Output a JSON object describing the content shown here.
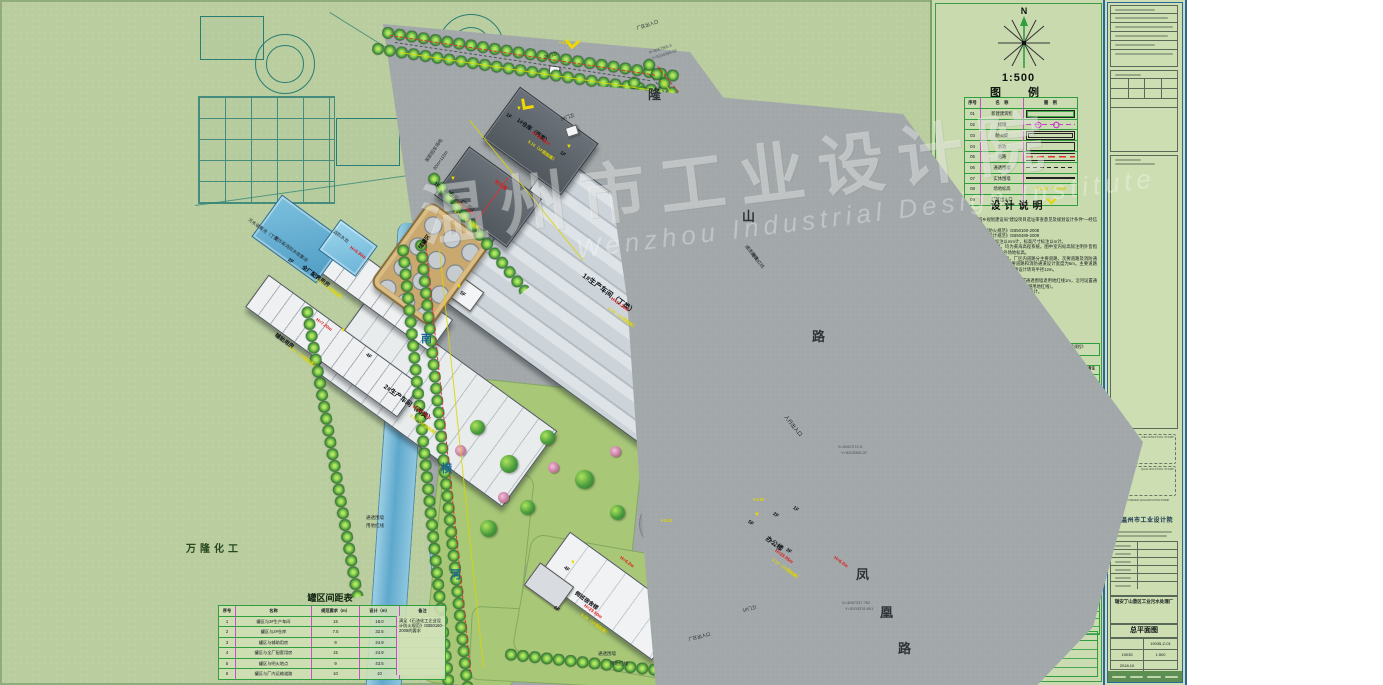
{
  "colors": {
    "sheet": "#b9cd9e",
    "road_gray": "#a2a7a9",
    "lawn": "#a8c878",
    "water": "#6fb4d6",
    "red_line": "#e03030",
    "dim_yellow": "#ded600",
    "table_magenta": "#c84fc8",
    "table_green": "#2f9e3f",
    "pad_tan": "#c9a96f",
    "logo_blue": "#1565c0"
  },
  "watermark": {
    "cn": "温州市工业设计院",
    "en": "Wenzhou Industrial Design Institute"
  },
  "plan": {
    "spacing_table": {
      "title": "罐区间距表",
      "headers": [
        "序号",
        "名称",
        "规范要求（m）",
        "设计（m）",
        "备注"
      ],
      "rows": [
        {
          "no": "1",
          "name": "罐区与2#生产车间",
          "req": "15",
          "des": "18.0"
        },
        {
          "no": "2",
          "name": "罐区与2#仓库",
          "req": "7.5",
          "des": "32.5"
        },
        {
          "no": "3",
          "name": "罐区与辅助用房",
          "req": "9",
          "des": "24.9"
        },
        {
          "no": "4",
          "name": "罐区与全厂配套用房",
          "req": "15",
          "des": "24.9"
        },
        {
          "no": "5",
          "name": "罐区与明火地点",
          "req": "9",
          "des": "43.5"
        },
        {
          "no": "6",
          "name": "罐区与厂内运输道路",
          "req": "10",
          "des": "10"
        }
      ],
      "note": "满足《石油化工企业设计防火规范》GB50160-2008的要求"
    },
    "labels": [
      {
        "t": "瑞安丁山垦区工业污水处理厂",
        "x": 213,
        "y": 62,
        "c": "site",
        "s": 13
      },
      {
        "t": "万隆化工",
        "x": 186,
        "y": 540,
        "c": "site2",
        "s": 10
      },
      {
        "t": "南",
        "x": 421,
        "y": 330,
        "c": "riv"
      },
      {
        "t": "横",
        "x": 441,
        "y": 460,
        "c": "riv"
      },
      {
        "t": "河",
        "x": 450,
        "y": 566,
        "c": "riv"
      },
      {
        "t": "隆",
        "x": 648,
        "y": 84,
        "c": "road"
      },
      {
        "t": "山",
        "x": 742,
        "y": 206,
        "c": "road"
      },
      {
        "t": "路",
        "x": 812,
        "y": 326,
        "c": "road"
      },
      {
        "t": "凤",
        "x": 856,
        "y": 564,
        "c": "road"
      },
      {
        "t": "凰",
        "x": 880,
        "y": 602,
        "c": "road"
      },
      {
        "t": "路",
        "x": 898,
        "y": 638,
        "c": "road"
      },
      {
        "t": "厂区出入口",
        "x": 636,
        "y": 26,
        "r": -18,
        "c": "sm"
      },
      {
        "t": "X=3067560.3",
        "x": 648,
        "y": 50,
        "r": -18,
        "c": "coord"
      },
      {
        "t": "Y=5200399.62",
        "x": 651,
        "y": 56,
        "r": -18,
        "c": "coord"
      },
      {
        "t": "2#门卫",
        "x": 543,
        "y": 55,
        "r": -18,
        "c": "sm"
      },
      {
        "t": "3#门卫",
        "x": 560,
        "y": 117,
        "r": -18,
        "c": "sm"
      },
      {
        "t": "装卸回车场地",
        "x": 424,
        "y": 160,
        "r": -55,
        "c": "sm"
      },
      {
        "t": "30m×110m",
        "x": 432,
        "y": 168,
        "r": -55,
        "c": "sm"
      },
      {
        "t": "人行出入口",
        "x": 788,
        "y": 414,
        "r": 51,
        "c": "s m"
      },
      {
        "t": "厂区出入口",
        "x": 688,
        "y": 637,
        "r": -14,
        "c": "sm"
      },
      {
        "t": "1#门卫",
        "x": 742,
        "y": 608,
        "r": -14,
        "c": "sm"
      },
      {
        "t": "X=3067274.5",
        "x": 838,
        "y": 444,
        "c": "coord"
      },
      {
        "t": "Y=5203356.37",
        "x": 841,
        "y": 450,
        "c": "coord"
      },
      {
        "t": "X=3067237.762",
        "x": 842,
        "y": 600,
        "c": "coord"
      },
      {
        "t": "Y=5203376.691",
        "x": 845,
        "y": 606,
        "c": "coord"
      },
      {
        "t": "通透围墙",
        "x": 748,
        "y": 244,
        "r": 51,
        "c": "sm"
      },
      {
        "t": "用地红线",
        "x": 754,
        "y": 252,
        "r": 51,
        "c": "sm"
      },
      {
        "t": "通透围墙",
        "x": 366,
        "y": 515,
        "c": "sm"
      },
      {
        "t": "用地红线",
        "x": 366,
        "y": 523,
        "c": "sm"
      },
      {
        "t": "通透围墙",
        "x": 598,
        "y": 651,
        "c": "sm"
      },
      {
        "t": "用地红线",
        "x": 610,
        "y": 661,
        "c": "sm"
      },
      {
        "t": "1F",
        "x": 508,
        "y": 112,
        "r": 36,
        "c": "fl"
      },
      {
        "t": "1#仓库（丙类）",
        "x": 520,
        "y": 116,
        "r": 36,
        "c": "bn"
      },
      {
        "t": "H=12.20m",
        "x": 534,
        "y": 130,
        "r": 36,
        "c": "red"
      },
      {
        "t": "5.10（1F底标高）",
        "x": 530,
        "y": 139,
        "r": 36,
        "c": "yel"
      },
      {
        "t": "1F",
        "x": 436,
        "y": 181,
        "r": 36,
        "c": "fl"
      },
      {
        "t": "2#仓库（乙类）",
        "x": 447,
        "y": 186,
        "r": 36,
        "c": "bn"
      },
      {
        "t": "防火墙",
        "x": 497,
        "y": 179,
        "r": 36,
        "c": "red"
      },
      {
        "t": "H=11.00m",
        "x": 459,
        "y": 200,
        "r": 36,
        "c": "red"
      },
      {
        "t": "5.10（1F底标高）",
        "x": 456,
        "y": 209,
        "r": 36,
        "c": "yel"
      },
      {
        "t": "1F",
        "x": 562,
        "y": 150,
        "r": 36,
        "c": "fl"
      },
      {
        "t": "1#生产车间（丁类）",
        "x": 586,
        "y": 271,
        "r": 36,
        "c": "bn",
        "s": 7
      },
      {
        "t": "H=17.20m",
        "x": 613,
        "y": 296,
        "r": 36,
        "c": "red"
      },
      {
        "t": "5.10（1F底标高）",
        "x": 610,
        "y": 306,
        "r": 36,
        "c": "yel"
      },
      {
        "t": "5F",
        "x": 462,
        "y": 290,
        "r": 36,
        "c": "fl"
      },
      {
        "t": "4F",
        "x": 368,
        "y": 352,
        "r": 36,
        "c": "fl"
      },
      {
        "t": "2#生产车间（丙类）",
        "x": 388,
        "y": 381,
        "r": 36,
        "c": "bn",
        "s": 6.5
      },
      {
        "t": "H=22.30m",
        "x": 415,
        "y": 404,
        "r": 36,
        "c": "red"
      },
      {
        "t": "5.10（1F底标高）",
        "x": 412,
        "y": 413,
        "r": 36,
        "c": "yel"
      },
      {
        "t": "2F",
        "x": 290,
        "y": 257,
        "r": 36,
        "c": "fl"
      },
      {
        "t": "全厂配套用房",
        "x": 305,
        "y": 263,
        "r": 36,
        "c": "bn"
      },
      {
        "t": "H=9.30m",
        "x": 352,
        "y": 245,
        "r": 36,
        "c": "red"
      },
      {
        "t": "5.10（1F底标高）",
        "x": 318,
        "y": 277,
        "r": 36,
        "c": "yel"
      },
      {
        "t": "辅助用房",
        "x": 278,
        "y": 331,
        "r": 36,
        "c": "bn"
      },
      {
        "t": "H=7.20m",
        "x": 318,
        "y": 317,
        "r": 36,
        "c": "red"
      },
      {
        "t": "5.10（1F底标高）",
        "x": 291,
        "y": 345,
        "r": 36,
        "c": "yel"
      },
      {
        "t": "储罐区",
        "x": 416,
        "y": 246,
        "r": -54,
        "c": "bn"
      },
      {
        "t": "污水收集池（丁类）",
        "x": 250,
        "y": 217,
        "r": 36,
        "c": "sm"
      },
      {
        "t": "受污染消防水收集池",
        "x": 276,
        "y": 235,
        "r": 36,
        "c": "sm"
      },
      {
        "t": "消防水池",
        "x": 335,
        "y": 229,
        "r": 36,
        "c": "sm"
      },
      {
        "t": "5F",
        "x": 750,
        "y": 519,
        "r": 36,
        "c": "fl"
      },
      {
        "t": "2F",
        "x": 775,
        "y": 511,
        "r": 36,
        "c": "fl"
      },
      {
        "t": "1F",
        "x": 795,
        "y": 505,
        "r": 36,
        "c": "fl"
      },
      {
        "t": "3F",
        "x": 788,
        "y": 547,
        "r": 36,
        "c": "fl"
      },
      {
        "t": "办公楼",
        "x": 770,
        "y": 533,
        "r": 36,
        "c": "bn",
        "s": 6.5
      },
      {
        "t": "H=23.95m",
        "x": 777,
        "y": 548,
        "r": 36,
        "c": "red"
      },
      {
        "t": "5.10（1F底标高）",
        "x": 774,
        "y": 557,
        "r": 36,
        "c": "yel"
      },
      {
        "t": "H=6.0m",
        "x": 836,
        "y": 555,
        "r": 36,
        "c": "red"
      },
      {
        "t": "4F",
        "x": 566,
        "y": 565,
        "r": 36,
        "c": "fl"
      },
      {
        "t": "6F",
        "x": 556,
        "y": 605,
        "r": 36,
        "c": "fl"
      },
      {
        "t": "倒班宿舍楼",
        "x": 578,
        "y": 589,
        "r": 36,
        "c": "bn"
      },
      {
        "t": "H=23.50m",
        "x": 586,
        "y": 603,
        "r": 36,
        "c": "red"
      },
      {
        "t": "5.20（1F底标高）",
        "x": 583,
        "y": 612,
        "r": 36,
        "c": "yel"
      },
      {
        "t": "H=4.2m",
        "x": 622,
        "y": 555,
        "r": 36,
        "c": "red"
      },
      {
        "t": "▼4.90",
        "x": 752,
        "y": 497,
        "c": "yel"
      },
      {
        "t": "▼4.90",
        "x": 558,
        "y": 40,
        "c": "yel"
      },
      {
        "t": "▼5.10",
        "x": 660,
        "y": 518,
        "c": "yel"
      },
      {
        "t": "▼",
        "x": 516,
        "y": 106,
        "c": "flagy"
      },
      {
        "t": "▼",
        "x": 450,
        "y": 176,
        "c": "flagy"
      },
      {
        "t": "▼",
        "x": 566,
        "y": 144,
        "c": "flagy"
      },
      {
        "t": "▼",
        "x": 456,
        "y": 284,
        "c": "flagy"
      },
      {
        "t": "▼",
        "x": 340,
        "y": 328,
        "c": "flagy"
      },
      {
        "t": "▼",
        "x": 426,
        "y": 206,
        "c": "flagy"
      },
      {
        "t": "▼",
        "x": 754,
        "y": 512,
        "c": "flagy"
      },
      {
        "t": "▼",
        "x": 570,
        "y": 560,
        "c": "flagy"
      }
    ]
  },
  "panel": {
    "north": "N",
    "scale": "1:500",
    "legend": {
      "title": "图　例",
      "headers": [
        "序号",
        "名　称",
        "图　例"
      ],
      "rows": [
        {
          "no": "01",
          "name": "新建建筑物",
          "sym": "sym-building",
          "symtext": ""
        },
        {
          "no": "02",
          "name": "储罐",
          "sym": "sym-tank",
          "symtext": ""
        },
        {
          "no": "03",
          "name": "防火堤",
          "sym": "sym-dike",
          "symtext": ""
        },
        {
          "no": "04",
          "name": "水池",
          "sym": "sym-pool",
          "symtext": ""
        },
        {
          "no": "05",
          "name": "道路",
          "sym": "sym-road",
          "symtext": ""
        },
        {
          "no": "06",
          "name": "通透围墙",
          "sym": "sym-fence-open",
          "symtext": ""
        },
        {
          "no": "07",
          "name": "实体围墙",
          "sym": "sym-fence-solid",
          "symtext": ""
        },
        {
          "no": "08",
          "name": "场地标高",
          "sym": "sym-elev",
          "symtext": "▼5.10　▽4.90"
        },
        {
          "no": "09",
          "name": "厂区出入口",
          "sym": "sym-gate",
          "symtext": ""
        }
      ]
    },
    "design_notes": {
      "title": "设计说明",
      "lines": [
        "1、设计依据：",
        "　1）瑞安市住房和城乡规划建设局“建设项目选址审查意见及规划设计条件”—经信建规条字〔2017〕号。",
        "　2）《石油化工企业设计防火规范》GB50160-2008",
        "　3）《化工企业总图运输设计规范》GB50489-2009",
        "2、图中所注明之建筑物尺寸标注以mm计，标高尺寸标注以m计。",
        "3、图中标高系统同用地红线图，均为黄海高程系统。图中室内标高除注明外皆指室内±0.00标高，室外标高皆指室外场地标高。",
        "4、厂区道路为城市型，混凝土路面，厂区内道路分主要道路、次要道路及消防通道三类。主要道路设计宽度15m，次要道路和消防通道设计宽度为6m。主要道路及次要道路均可兼作消防通道使用，道路设计转弯半径12m。",
        "5、建筑物耐火等级均为二级。",
        "6、各相邻厂区之间设置实体围墙，沿街设置通透围墙退用地红线1m，沿河设置通透围墙退用地红线0.5m（沿河围墙基础不得逾越用地红线）。",
        "7、图中坐标、尺寸和标高单位除注明外，均以米计。",
        "8、本图为工程规划许可证附图。"
      ]
    },
    "indicators": {
      "title": "技术经济指标",
      "basis_label": "计算建筑面积依据",
      "basis_text": "浙江省工程建设标准《建筑工程建筑面积计算和竣工综合测量技术规程》（DB33/T 1152-2018）",
      "headers": [
        "序号",
        "指标名称",
        "单位",
        "数量",
        "单位",
        "计入容积率建筑面积",
        "备注"
      ],
      "groups": [
        "非生产性",
        "生产性",
        "非生产性",
        "生产性"
      ],
      "rows": [
        {
          "no": "1",
          "name": "建设用地面积",
          "u1": "m²",
          "q": "80000（120亩）",
          "u2": "",
          "far": "建筑面积",
          "nt": ""
        },
        {
          "no": "2",
          "name": "总建筑面积",
          "u1": "m²",
          "q": "45342.08",
          "u2": "m²",
          "far": "44901.55",
          "nt": ""
        },
        {
          "name": "倒班宿舍",
          "u1": "m²",
          "q": "4799.91",
          "u2": "m²",
          "far": "4799.91",
          "ic": "ind"
        },
        {
          "name": "办公楼",
          "u1": "m²",
          "q": "5884.31",
          "u2": "m²",
          "far": "7095.05",
          "nt": "H=>5.4m",
          "ic": "ind"
        },
        {
          "name": "1#门卫",
          "u1": "m²",
          "q": "40",
          "u2": "m²",
          "far": "40",
          "ic": "ind"
        },
        {
          "name": "2#门卫",
          "u1": "m²",
          "q": "14.70",
          "u2": "m²",
          "far": "14.70",
          "ic": "ind"
        },
        {
          "name": "3#门卫",
          "u1": "m²",
          "q": "14.70",
          "u2": "m²",
          "far": "14.70",
          "ic": "ind"
        },
        {
          "name": "1#仓库",
          "u1": "m²",
          "q": "914.46",
          "u2": "m²",
          "far": "1828.92",
          "nt": "H=>8m",
          "ic": "ind"
        },
        {
          "name": "2#仓库",
          "u1": "m²",
          "q": "713.26",
          "u2": "m²",
          "far": "1426.52",
          "nt": "H=>8m",
          "ic": "ind"
        },
        {
          "name": "1#生产车间",
          "u1": "m²",
          "q": "15617.58",
          "u2": "m²",
          "far": "31235.16",
          "nt": "H=>8m",
          "ic": "ind"
        },
        {
          "name": "2#生产车间",
          "u1": "m²",
          "q": "13482.42",
          "u2": "m²",
          "far": "13482.42",
          "ic": "ind"
        },
        {
          "name": "全厂配套用房",
          "u1": "m²",
          "q": "1386.51",
          "u2": "m²",
          "far": "1715.92",
          "nt": "H=>8m",
          "ic": "ind"
        },
        {
          "name": "辅助用房",
          "u1": "m²",
          "q": "1374.04",
          "u2": "m²",
          "far": "1374.04",
          "ic": "ind"
        },
        {
          "name": "屋顶设施",
          "u1": "m²",
          "q": "—",
          "u2": "m²",
          "far": "3000",
          "ic": "ind"
        },
        {
          "no": "3",
          "name": "容积率",
          "u1": "",
          "q": "0.84"
        },
        {
          "no": "4",
          "name": "非生产用地比",
          "u1": "%",
          "q": "4.26"
        },
        {
          "no": "5",
          "name": "非生产建筑比",
          "u1": "%",
          "q": "28.35"
        },
        {
          "no": "6",
          "name": "建筑基底总面积",
          "u1": "m²",
          "q": "27394.48"
        },
        {
          "name": "倒班宿舍",
          "u1": "m²",
          "q": "1353.18",
          "ic": "ind"
        },
        {
          "name": "办公楼",
          "u1": "m²",
          "q": "1964.74",
          "ic": "ind"
        },
        {
          "name": "1#门卫",
          "u1": "m²",
          "q": "40",
          "ic": "ind"
        },
        {
          "name": "2#门卫",
          "u1": "m²",
          "q": "14.70",
          "ic": "ind"
        },
        {
          "name": "3#门卫",
          "u1": "m²",
          "q": "14.70",
          "ic": "ind"
        },
        {
          "name": "1#仓库",
          "u1": "m²",
          "q": "914.46",
          "ic": "ind"
        },
        {
          "name": "2#仓库",
          "u1": "m²",
          "q": "713.26",
          "ic": "ind"
        },
        {
          "name": "1#生产车间",
          "u1": "m²",
          "q": "15617.58",
          "ic": "ind"
        },
        {
          "name": "2#生产车间",
          "u1": "m²",
          "q": "3030.14",
          "ic": "ind"
        },
        {
          "name": "全厂配套用房",
          "u1": "m²",
          "q": "1387.58",
          "ic": "ind"
        },
        {
          "name": "辅助用房",
          "u1": "m²",
          "q": "676.14",
          "ic": "ind"
        },
        {
          "name": "屋顶设施",
          "u1": "m²",
          "q": "2000",
          "ic": "ind"
        },
        {
          "no": "7",
          "name": "建筑密度",
          "u1": "%",
          "q": "34.21"
        },
        {
          "no": "8",
          "name": "绿地总面积",
          "u1": "m²",
          "q": "16000"
        },
        {
          "name": "绿地率",
          "u1": "%",
          "q": "20.0"
        },
        {
          "no": "9",
          "name": "机动车泊位",
          "u1": "辆",
          "q": "100"
        },
        {
          "no": "10",
          "name": "非机动车停放数量",
          "u1": "辆",
          "q": "200"
        },
        {
          "no": "11",
          "name": "场地标高",
          "u1": "米",
          "q": "4.90"
        }
      ],
      "notes_title": "注：",
      "notes": [
        "1、建筑面积计算依据《瑞安市城市规划管理技术规定》温政发〔2013〕27号。",
        "2、停车位配建计算依据《浙江省城市建筑工程停车场（库）设置规则和配建标准》〔2016〕号。",
        "3、屋顶设施为预留设备用房、采光天窗、露天设备及管道等。",
        "4、停车位计算方法见如下表。"
      ],
      "parking": {
        "title": "机动车停车位需求量计算",
        "rows": [
          {
            "name": "办公用房",
            "calc": "12863.42×0.6÷100×0.8=62"
          },
          {
            "name": "生产车间",
            "calc": "30862.76×0.15÷100=47"
          },
          {
            "name": "仓库",
            "calc": "1627.72×0.25÷100=4"
          },
          {
            "name": "合计",
            "calc": "62+47+4=113"
          }
        ]
      }
    }
  },
  "strip": {
    "org": "温州市工业设计院",
    "reg_stamp": "REGISTRATION STAMP",
    "qual_stamp": "QUALIFICATION STAMP",
    "cert_note": "PROJECT DESIGN QUALIFICATION STAMP",
    "project": "瑞安丁山垦区工业污水处理厂",
    "drawing_title": "总平面图",
    "drawing_no": "19035-Z-01",
    "contract_no": "19035",
    "date": "2018.10",
    "scale": "1:500"
  }
}
